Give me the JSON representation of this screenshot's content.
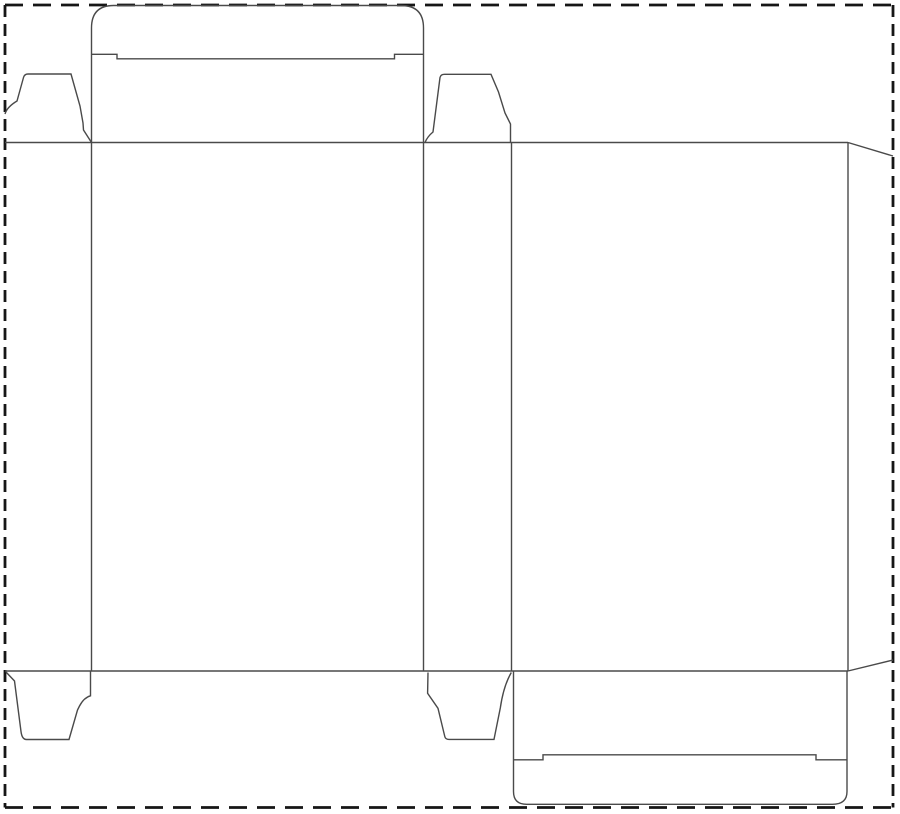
{
  "title": "reverse-tuck-end-carton-dieline",
  "canvas": {
    "width": 900,
    "height": 814,
    "viewbox": "0 0 900 814",
    "background": "#ffffff"
  },
  "styles": {
    "cut_line_color": "#4a4a4a",
    "cut_line_width": "1.4px",
    "border_color": "#161616",
    "border_width": "2.8px",
    "border_dash_horizontal": "18 10",
    "border_dash_vertical": "12 7",
    "canvas_bg": "#ffffff"
  },
  "border": {
    "left": 5,
    "top": 5,
    "right": 893,
    "bottom": 807.5
  },
  "paths": {
    "border_top": "M5 5 H893",
    "border_bottom": "M5 807.5 H893",
    "border_left": "M5 5 V807.5",
    "border_right": "M893 5 V807.5",
    "fold_line_top": "M5 142.5 H848",
    "fold_line_bottom": "M5 671 H848",
    "panel_divider_1": "M91.5 142.5 V671",
    "panel_divider_2": "M423.5 142.5 V671",
    "panel_divider_3": "M511.5 142.5 V671",
    "panel_divider_4": "M848 142.5 V671",
    "top_lid_outline": "M91.5 142.5 V28 Q91.5 5.5 113.5 5.5 H401 Q423.5 5.5 423.5 28 V142.5",
    "top_lid_slit_line": "M91.5 54.3 H117 V58.8 H394.5 V54.3 H423.5",
    "dust_flap_top_left": "M5 114 Q7 107 17 101 L23.5 77.5 Q24.5 74 28 74 L71 74 L80 106 L83 123 L83.5 130 L91.5 142.5",
    "dust_flap_top_middle": "M425 142.5 Q427.5 136.5 433 132 L440 77.5 Q440.8 74.3 444.5 74.3 L491 74.3 L498.5 92 L505 113 L510.5 124 L510.5 142.5",
    "glue_flap_top_edge": "M848 142.5 L893 156",
    "glue_flap_bottom_edge": "M848 671 L893 660",
    "dust_flap_bottom_left": "M6 672 L14.5 681 L21 731.5 Q22 739.5 26.5 739.5 L69 739.5 L77.5 710 L79.5 706 Q84 697.5 90.5 695.8 L90.5 671",
    "dust_flap_bottom_middle": "M428 672.5 L427.6 693.3 L438 708.3 L444.8 736.5 Q445.4 739.4 449 739.4 L494 739.4 L500.3 708 Q503.5 686 511.3 672.5",
    "bottom_lid_outline": "M513.5 671.5 V791.5 Q513.5 804.3 526.5 804.3 H832.5 Q847 804.3 847 791.5 V671.5",
    "bottom_lid_slit_line": "M513.5 759.8 H543 V754.8 H816 V759.8 H847"
  }
}
